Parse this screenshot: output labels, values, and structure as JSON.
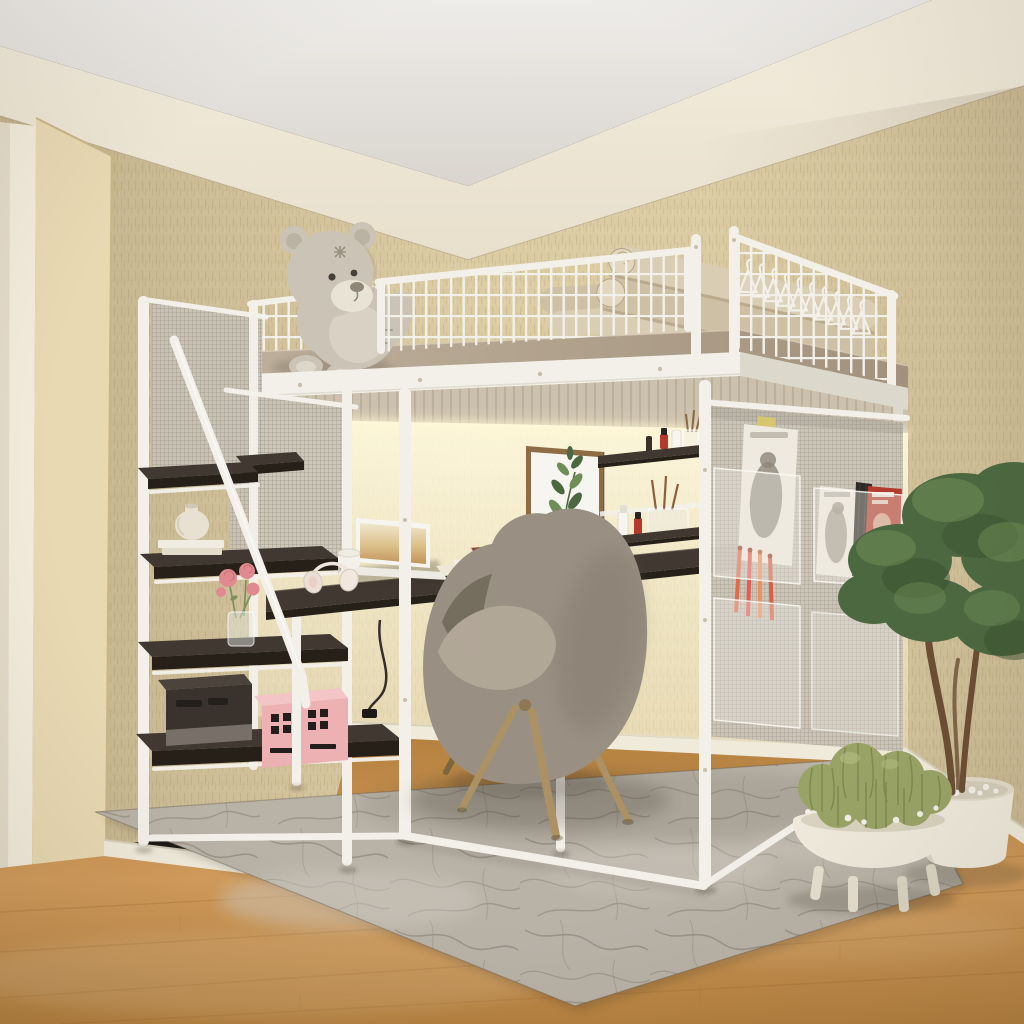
{
  "scene": {
    "title": "3D render: bedroom with white metal loft bed, desk, storage staircase, lounge chair and plants",
    "description": "A white metal loft bed with grid guardrails stands against a beige textured wall. A grey teddy bear and rolled mattress pads sit on top. Below are a dark wood desk with laptop, a storage staircase with shelves, a hanging mesh organizer with magazines, a grey boucle lounge chair on a marble-pattern rug, and potted plants on a wood floor."
  },
  "palette": {
    "ceilA": "#eeece9",
    "ceilB": "#d9d5ce",
    "bandA": "#f4edde",
    "bandB": "#e8dfcc",
    "wall": "#dbcca4",
    "wallDeep": "#c2b189",
    "wallLine": "#a8967a",
    "door": "#f3ecdc",
    "doorWood": "#e8d9b3",
    "doorWoodEdge": "#c8b58a",
    "base": "#f0eadb",
    "baseShade": "#d6cfbc",
    "floorA": "#d29c5c",
    "floorB": "#b5813f",
    "floorLine": "#9a682e",
    "rug": "#b9b2a7",
    "rugLite": "#cec8be",
    "rugVein": "#8d857a",
    "frame": "#f3f0e9",
    "frameShade": "#ddd8cc",
    "frameDark": "#c2bcae",
    "deckA": "#bdaf9b",
    "deckB": "#a2927d",
    "soffit": "#ccc1af",
    "soffitLine": "#a99d87",
    "darkTop": "#413931",
    "darkEdge": "#262019",
    "darkHi": "#5d5248",
    "led": "#fff7d9",
    "glowA": "rgba(255,250,224,0.92)",
    "glowB": "rgba(250,240,206,0.38)",
    "teddy": "#cbc3b6",
    "teddyShade": "#afa695",
    "teddyLite": "#ddd7cb",
    "muzzle": "#e9e3d5",
    "stitch": "#93897a",
    "mattress": "#d9cdb3",
    "mattress2": "#cdc0a4",
    "mattressLine": "#b3a386",
    "meshFill": "#c9c3b7",
    "meshLine": "#9d968a",
    "pocket": "rgba(236,233,225,0.38)",
    "pocketEdge": "rgba(252,250,244,0.85)",
    "mag": "#efeadf",
    "magInk": "#8d8679",
    "magRed": "#b43c2e",
    "magFace": "#d9a98e",
    "magYellow": "#d9c86a",
    "penA": "#e06a4a",
    "penB": "#e85a50",
    "penC": "#f09060",
    "penD": "#d95f45",
    "chair": "#9a9083",
    "chairDark": "#6c6455",
    "chairLite": "#b2a898",
    "chairDot": "#5d564a",
    "woodLeg": "#ab9164",
    "woodLegDark": "#7c663f",
    "green": "#4c6840",
    "greenLite": "#6f8d56",
    "greenDark": "#384f2e",
    "trunk": "#6b4f35",
    "cactus": "#99a366",
    "cactusDark": "#68743f",
    "cactusHi": "#bac387",
    "pot": "#efe9dc",
    "potShade": "#cfc7b2",
    "pebble": "#f2efe7",
    "pink": "#edb1b3",
    "pinkTop": "#f3c5c6",
    "pinkInk": "#231e1b",
    "boxDark": "#3a332d",
    "boxTop": "#4b433c",
    "boxMetal": "#8d857c",
    "red": "#b6392d",
    "white": "#f7f5ef",
    "paper": "#efe8d6",
    "book": "#8a4a2e",
    "rose": "#e08a8f",
    "roseDeep": "#c4666f",
    "leaf": "#7d8f5f",
    "artWood": "#8d6c46",
    "cord": "#201b17",
    "shadow": "#352d22",
    "bolt": "#c7beaa"
  },
  "objects": {
    "ceiling": "White ceiling",
    "upperBand": "Smooth upper wall band",
    "wall": "Beige textured wallpaper wall",
    "doorway": "Doorway with wooden frame",
    "baseboard": "Cream baseboards",
    "floor": "Warm oak laminate floor",
    "rug": "Grey abstract marble area rug",
    "glow": "Warm LED wash on wall under loft",
    "wallArt": "Framed eucalyptus watercolor print",
    "loftBed": "White metal loft bed frame",
    "platform": "Loft platform with slatted underside and LED strip",
    "guardrailLeft": "Left grid guardrail",
    "guardrailFront": "Front grid guardrail",
    "guardrailRight": "Right grid guardrail",
    "mattress": "Rolled beige mattress pads",
    "hangers": "White clothes hangers on rail",
    "teddy": "Grey plush teddy bear",
    "stairs": "Storage staircase with dark wood shelf steps",
    "meshPanels": "Grey mesh safety panels",
    "handrail": "White stair handrail",
    "ceramicVase": "Cream ceramic vase on white books",
    "roseVase": "Glass vase with pink roses",
    "darkBox": "Dark storage case",
    "pinkBox": "Pink storage box with black pattern",
    "desk": "Dark wood desk under the loft",
    "laptop": "Open laptop",
    "headphones": "White headphones",
    "mug": "White mug",
    "papers": "Papers and a book",
    "cord": "Power cord and plug",
    "cosmetics": "Wall shelves with cosmetics and brushes",
    "organizer": "Hanging mesh organizer with pockets",
    "magazines": "Magazines in organizer pockets",
    "pens": "Coloured pens in pocket",
    "chair": "Grey boucle lounge chair with wooden legs",
    "tree": "Potted green tree in white planter",
    "cactus": "Bowl of cacti on white footed stand"
  }
}
